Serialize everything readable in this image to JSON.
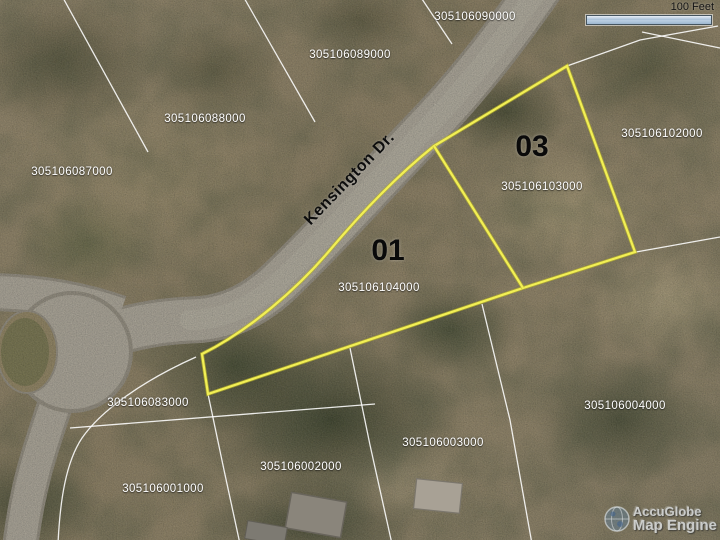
{
  "map": {
    "street_label": "Kensington Dr.",
    "scale": {
      "label": "100 Feet"
    },
    "watermark": {
      "line1": "AccuGlobe",
      "line2": "Map Engine"
    },
    "colors": {
      "highlight": "#f2ef55",
      "parcel_line": "#ffffff",
      "road": "#a7a296",
      "scale_bar_fill": "#aec6dd"
    },
    "lot_labels": [
      {
        "text": "01"
      },
      {
        "text": "03"
      }
    ],
    "parcel_ids": [
      {
        "text": "305106090000"
      },
      {
        "text": "305106089000"
      },
      {
        "text": "305106088000"
      },
      {
        "text": "305106087000"
      },
      {
        "text": "305106102000"
      },
      {
        "text": "305106103000"
      },
      {
        "text": "305106104000"
      },
      {
        "text": "305106083000"
      },
      {
        "text": "305106004000"
      },
      {
        "text": "305106003000"
      },
      {
        "text": "305106002000"
      },
      {
        "text": "305106001000"
      }
    ]
  }
}
